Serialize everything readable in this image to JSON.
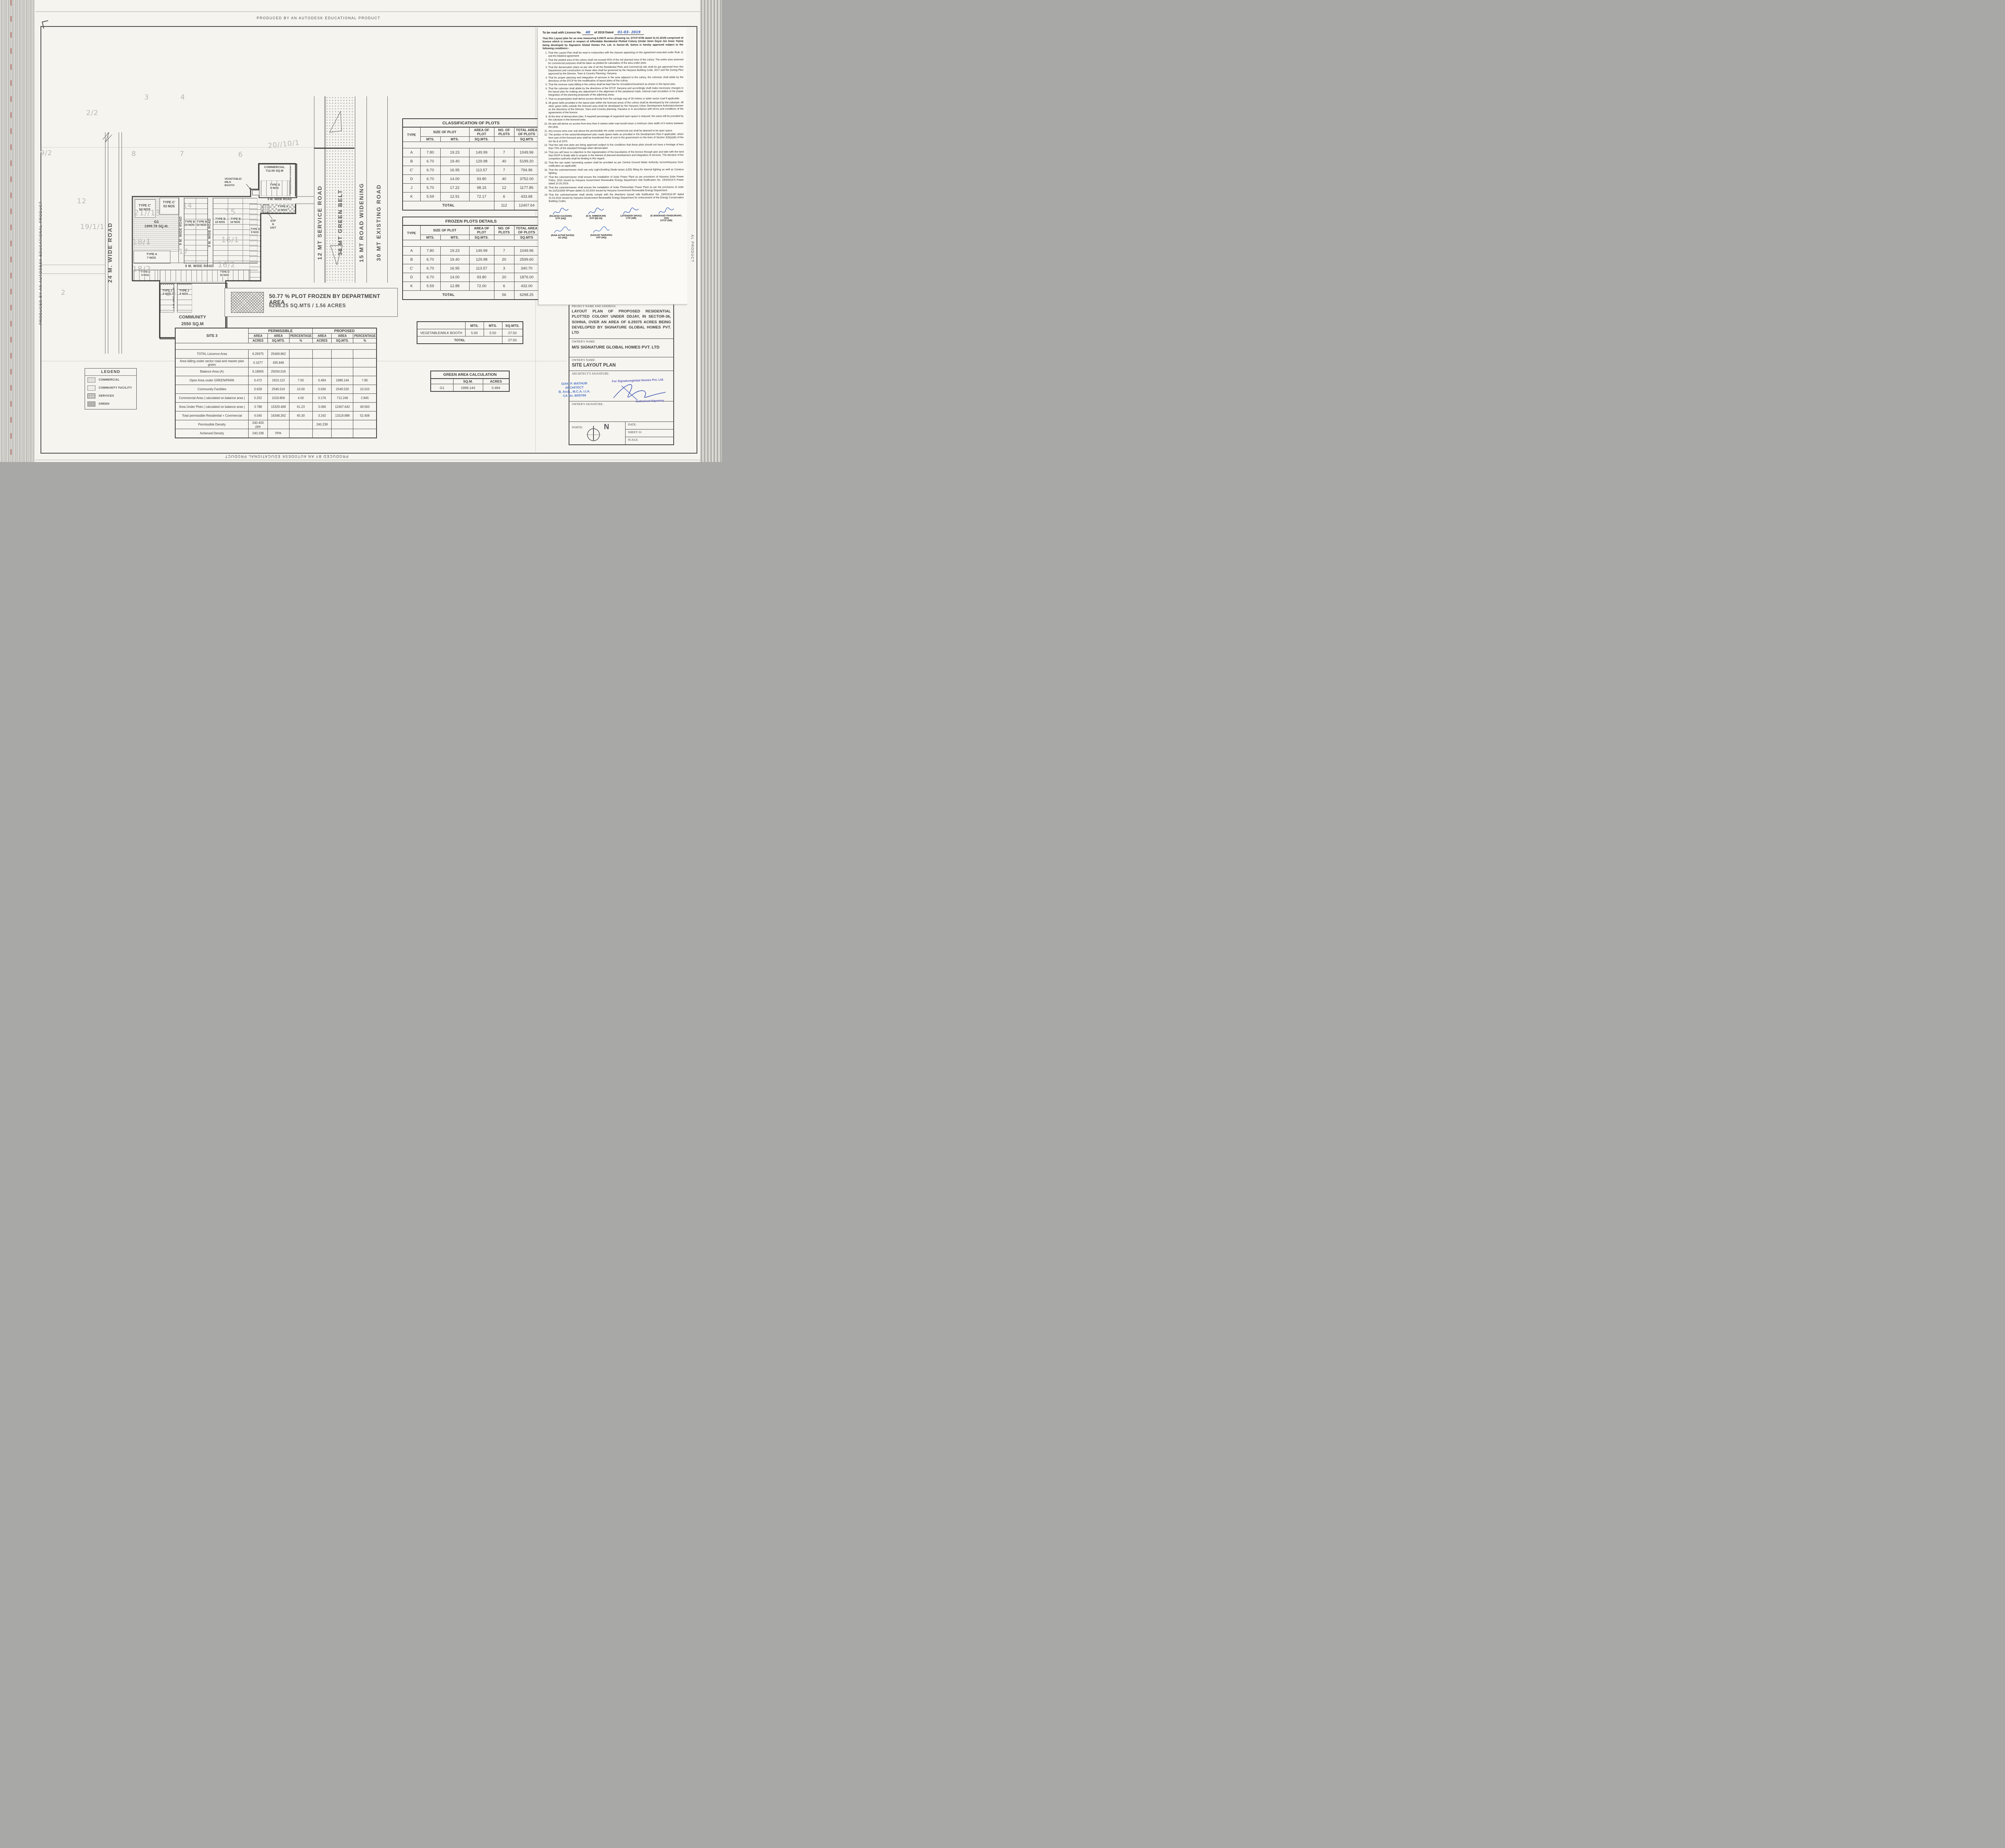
{
  "border": {
    "autodesk": "PRODUCED BY AN AUTODESK EDUCATIONAL PRODUCT",
    "autodesk_right": "AL PRODUCT"
  },
  "licence": {
    "header": {
      "prefix": "To be read with Licence No.",
      "no": "40",
      "mid": "of 2019  Dated",
      "date": "01-03- 2019"
    },
    "intro": "That this Layout plan for an area measuring 6.29375 acres (Drawing no. DTCP-6785 dated 31.01.2019) comprised of licence which is issued in respect of Affordable Residential Plotted Colony (Under Deen Dayal Jan Awas Yojna) being developed by Signature Global Homes Pvt. Ltd. in Sector-36, Sohna is hereby approved subject to the following conditions:-",
    "conditions": [
      "That this Layout Plan shall be read in conjunction with the clauses appearing on the agreement executed under Rule 11 and the bilateral agreement.",
      "That the plotted area of the colony shall not exceed 65% of the net planned area of the colony. The entire area reserved for commercial purposes shall be taken as plotted for calculation of the area under plots.",
      "That the demarcation plans as per site of all the Residential Plots and Commercial site shall be got approved from this Department and construction on these sites shall be governed by the Haryana Building Code, 2017 and the Zoning Plan approved by the Director, Town & Country Planning, Haryana.",
      "That for proper planning and integration of services in the area adjacent to the colony, the colonizer shall abide by the directions of the DTCP for the modification of layout plans of the colony.",
      "That the revenue rasta falling in the colony shall be kept free for circulation/movement as shown in the layout plan.",
      "That the colonizer shall abide by the directions of the DTCP, Haryana and accordingly shall make necessary changes in the layout plan for making any adjustment in the alignment of the peripheral roads, internal road circulation or for proper integration of the planning proposals of the adjoining areas.",
      "That no property/plot shall derive access directly from the carriage way of 30 metres or wider sector road if applicable.",
      "All green belts provided in the layout plan within the licenced areas of the colony shall be developed by the colonizer. All other green belts outside the licenced area shall be developed by the Haryana Urban Development Authority/colonizer on the directions of the Director, Town and Country planning, Haryana or in accordance with terms and conditions of the  agreements of the licence.",
      "At the time of demarcation plan, if required percentage of organized open space is reduced, the same will be provided by the colonizer in the licenced area.",
      "No plot will derive an access from less than 9 metres wide road would mean a minimum clear width of 9 metres between the plots.",
      "Any excess area over and above the permissible 4% under commercial use shall be deemed to be open space.",
      "The portion of the sector/development plan roads /green belts as provided in the Development Plan if applicable, which form part of the licenced area shall be transferred free of cost to the government on the lines of Section 3(3)(a)(iii) of the Act No.8 of 1975.",
      "That the odd size plots are being approved subject to the conditions that these plots should not have a frontage of less than 75% of the standard frontage when demarcated.",
      "That you will have no objection to the regularization of the boundaries of the licence through give and take with the land that HSVP is finally able to acquire in the interest of planned development and integration of services. The decision of the competent authority shall be binding in this regard.",
      "That the rain water harvesting system shall be provided as per Central Ground Water Authority norms/Haryana Govt. notification as applicable.",
      "That the coloniser/owner shall use only Light-Emitting Diode lamps (LED) fitting for internal lighting as well as Campus lighting.",
      "That the colonizer/owner shall ensure the installation of Solar Power Plant as per provisions of Haryana Solar Power Policy, 2016 issued by Haryana Government Renewable Energy Department vide Notification No. 19/4/2016-5 Power dated 14.03.2016.",
      "That the colonizer/owner shall ensure the installation of Solar Photovoltaic Power Plant as per the provisions of order No.22/52/2005-5Power dated 21.03.2016 issued by Haryana Government Renewable Energy Department.",
      "That the colonizer/owner shall strictly comply with the directions issued vide Notification No. 19/6/2016-5P dated 31.03.2016 issued by Haryana Government Renewable Energy Department for enforcement of the Energy Conservation Building Codes."
    ],
    "signatories_row1": [
      {
        "name": "(RAJESH KAUSHIK)",
        "title": "DTP (HQ)"
      },
      {
        "name": "(D.N. NIMBOKAR)",
        "title": "STP (M) HQ"
      },
      {
        "name": "(JITENDER SIHAG)",
        "title": "CTP (HR)"
      },
      {
        "name": "(K.MAKRAND PANDURANG, IAS)",
        "title": "DTCP (HR)"
      }
    ],
    "signatories_row2": [
      {
        "name": "(RAM AVTAR BASSI)",
        "title": "AD (HQ)"
      },
      {
        "name": "(SANJAY NARANG)",
        "title": "ATP (HQ)"
      }
    ]
  },
  "tables": {
    "classification": {
      "title": "CLASSIFICATION OF PLOTS",
      "col_type": "TYPE",
      "col_size": "SIZE OF PLOT",
      "col_area": "AREA OF PLOT",
      "col_nos": "NO. OF PLOTS",
      "col_total": "TOTAL AREA OF PLOTS",
      "u_mts1": "MTS.",
      "u_mts2": "MTS.",
      "u_sqmts": "SQ.MTS.",
      "u_sqmts2": "SQ.MTS",
      "rows": [
        {
          "t": "A",
          "w": "7.80",
          "l": "19.23",
          "a": "149.99",
          "n": "7",
          "ta": "1049.96"
        },
        {
          "t": "B",
          "w": "6.70",
          "l": "19.40",
          "a": "129.98",
          "n": "40",
          "ta": "5199.20"
        },
        {
          "t": "C'",
          "w": "6.70",
          "l": "16.95",
          "a": "113.57",
          "n": "7",
          "ta": "794.96"
        },
        {
          "t": "D",
          "w": "6.70",
          "l": "14.00",
          "a": "93.80",
          "n": "40",
          "ta": "3752.00"
        },
        {
          "t": "J",
          "w": "5.70",
          "l": "17.22",
          "a": "98.15",
          "n": "12",
          "ta": "1177.85"
        },
        {
          "t": "K",
          "w": "5.59",
          "l": "12.91",
          "a": "72.17",
          "n": "6",
          "ta": "433.68"
        }
      ],
      "total_label": "TOTAL",
      "total_nos": "112",
      "total_area": "12407.64"
    },
    "frozen": {
      "title": "FROZEN PLOTS DETAILS",
      "col_type": "TYPE",
      "col_size": "SIZE OF PLOT",
      "col_area": "AREA OF PLOT",
      "col_nos": "NO. OF PLOTS",
      "col_total": "TOTAL AREA OF PLOTS",
      "u_mts1": "MTS.",
      "u_mts2": "MTS.",
      "u_sqmts": "SQ.MTS.",
      "u_sqmts2": "SQ.MTS",
      "rows": [
        {
          "t": "A",
          "w": "7.80",
          "l": "19.23",
          "a": "149.99",
          "n": "7",
          "ta": "1049.96"
        },
        {
          "t": "B",
          "w": "6.70",
          "l": "19.40",
          "a": "129.98",
          "n": "20",
          "ta": "2599.60"
        },
        {
          "t": "C'",
          "w": "6.70",
          "l": "16.95",
          "a": "113.57",
          "n": "3",
          "ta": "340.70"
        },
        {
          "t": "D",
          "w": "6.70",
          "l": "14.00",
          "a": "93.80",
          "n": "20",
          "ta": "1876.00"
        },
        {
          "t": "K",
          "w": "5.59",
          "l": "12.88",
          "a": "72.00",
          "n": "6",
          "ta": "432.00"
        }
      ],
      "total_label": "TOTAL",
      "total_nos": "56",
      "total_area": "6298.25"
    },
    "booth": {
      "u1": "MTS.",
      "u2": "MTS.",
      "u3": "SQ.MTS.",
      "label": "VEGETABLE/MILK BOOTH",
      "w": "5.00",
      "l": "5.50",
      "a": "27.50",
      "total_label": "TOTAL",
      "total": "27.50"
    },
    "green": {
      "title": "GREEN AREA CALCULATION",
      "h1": "SQ.M.",
      "h2": "ACRES",
      "row_label": "G1",
      "sqm": "1999.144",
      "acres": "0.494"
    },
    "site3": {
      "corner": "SITE 3",
      "permissible": "PERMISSIBLE",
      "proposed": "PROPOSED",
      "area": "AREA",
      "percentage": "PERCENTAGE",
      "acres": "ACRES",
      "sqmts": "SQ.MTS.",
      "pct": "%",
      "rows": [
        {
          "label": "TOTAL Liscence Area",
          "pa": "6.29375",
          "ps": "25469.862",
          "pp": "",
          "oa": "",
          "os": "",
          "op": ""
        },
        {
          "label": "Area falling under sector road and master plan green",
          "pa": "0.1077",
          "ps": "435.846",
          "pp": "",
          "oa": "",
          "os": "",
          "op": ""
        },
        {
          "label": "Balance Area (A)",
          "pa": "6.18605",
          "ps": "25034.016",
          "pp": "",
          "oa": "",
          "os": "",
          "op": ""
        },
        {
          "label": "Open Area under GREEN/PARK",
          "pa": "0.472",
          "ps": "1910.113",
          "pp": "7.50",
          "oa": "0.494",
          "os": "1999.144",
          "op": "7.85"
        },
        {
          "label": "Community Facilities",
          "pa": "0.629",
          "ps": "2546.516",
          "pp": "10.00",
          "oa": "0.630",
          "os": "2549.520",
          "op": "10.010"
        },
        {
          "label": "Commercial Area ( calculated on balance area )",
          "pa": "0.252",
          "ps": "1019.806",
          "pp": "4.00",
          "oa": "0.176",
          "os": "712.246",
          "op": "2.845"
        },
        {
          "label": "Area Under Plots ( calculated on balance area )",
          "pa": "3.788",
          "ps": "15329.468",
          "pp": "61.23",
          "oa": "3.066",
          "os": "12407.642",
          "op": "49.563"
        },
        {
          "label": "Total permissible Residential + Commercial",
          "pa": "4.040",
          "ps": "16348.262",
          "pp": "65.30",
          "oa": "3.242",
          "os": "13119.888",
          "op": "52.408"
        },
        {
          "label": "Permissible Density",
          "pa": "240-400 ppa",
          "ps": "",
          "pp": "",
          "oa": "240.238",
          "os": "",
          "op": ""
        },
        {
          "label": "Achieved Density",
          "pa": "240.238",
          "ps": "PPA",
          "pp": "",
          "oa": "",
          "os": "",
          "op": ""
        }
      ]
    }
  },
  "legend": {
    "title": "LEGEND",
    "items": [
      {
        "label": "COMMERCIAL",
        "cls": "sw sw-com"
      },
      {
        "label": "COMMUNITY FACILITY",
        "cls": "sw sw-cf"
      },
      {
        "label": "SERVICES",
        "cls": "sw sw-srv"
      },
      {
        "label": "GREEN",
        "cls": "sw sw-grn"
      }
    ]
  },
  "frozen_note": {
    "line1": "50.77 % PLOT FROZEN BY DEPARTMENT AREA",
    "line2": "6298.25 SQ.MTS / 1.56 ACRES"
  },
  "plan": {
    "roads": {
      "r24": "24 M. WIDE ROAD",
      "r9": "9 M. WIDE ROAD",
      "service": "12 MT SERVICE ROAD",
      "belt": "38 MT GREEN BELT",
      "widening": "15 MT ROAD WIDENING",
      "existing": "30 MT EXISTING ROAD",
      "approach": "APPROACH ROAD TO SITE-03"
    },
    "labels": {
      "c4": "TYPE C'\n04 NOS",
      "c3": "TYPE C'\n03 NOS",
      "g1": "G1\n1999.79 SQ.M.",
      "b10": "TYPE B\n10 NOS",
      "a7": "TYPE A\n7 NOS",
      "d9": "TYPE D\n9 NOS",
      "d16": "TYPE D\n16 NOS",
      "j6": "TYPE J\n6 NOS",
      "k6": "TYPE K\n6 NOS",
      "d6": "TYPE D\n6 NOS",
      "commercial": "COMMERCIAL\n712.00 SQ.M",
      "community": "COMMUNITY\n2550 SQ.M",
      "booth": "VEGETABLE/\nMILK\nBOOTH",
      "stp": "STP\n&\nUGT"
    },
    "khasra": [
      "2/2",
      "3",
      "4",
      "9/2",
      "8",
      "7",
      "6",
      "20//10/1",
      "12",
      "19/1/1",
      "2",
      "21//13",
      "18/1",
      "18/2",
      "14",
      "15",
      "16/1",
      "16/2",
      "17",
      "24"
    ]
  },
  "title_block": {
    "project_label": "PROJECT NAME AND ADDRESS:",
    "project_text": "LAYOUT PLAN OF PROPOSED RESIDENTIAL PLOTTED COLONY UNDER DDJAY, IN SECTOR-36, SOHNA, OVER AN AREA OF 6.29375 ACRES BEING DEVELOPED BY SIGNATURE GLOBAL HOMES PVT. LTD",
    "owner_label": "OWNER'S NAME:",
    "owner_name": "M/S SIGNATURE GLOBAL HOMES PVT. LTD",
    "owner_label2": "OWNER'S NAME:",
    "drawing_title": "SITE LAYOUT PLAN",
    "architect_label": "ARCHITECT'S SIGNATURE:",
    "stamp": "GIAN P. MATHUR\nARCHITECT\nB. Arch., M.C.A. I.I.A.\nCA No. 80/5769",
    "for_company": "For Signatureglobal Homes Pvt. Ltd.",
    "auth": "Authorised Signatory",
    "owner_sig_label": "OWNER'S SIGNATURE:",
    "north_label": "NORTH:",
    "north_n": "N",
    "date_label": "DATE:",
    "sheet_label": "SHEET: 01",
    "scale_label": "SCALE:"
  }
}
